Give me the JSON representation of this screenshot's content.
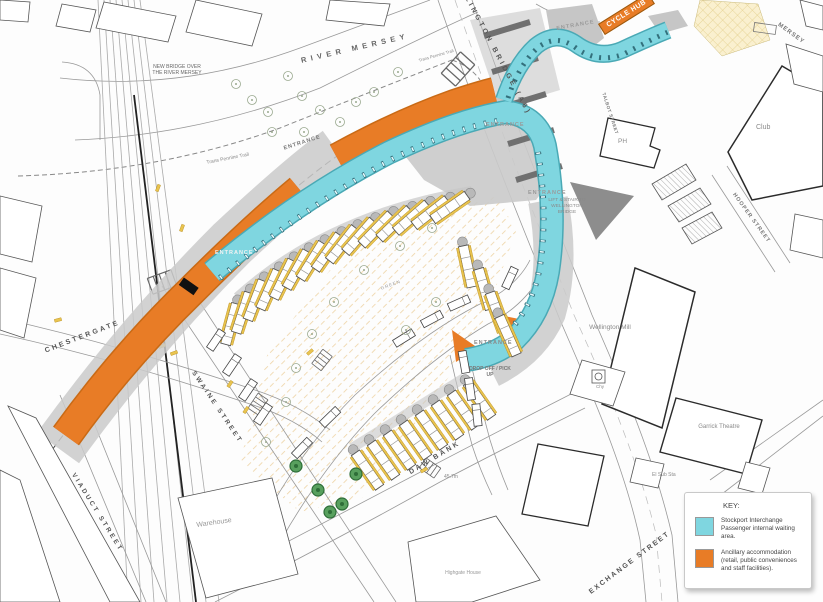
{
  "labels": {
    "river": "RIVER MERSEY",
    "new_bridge": "NEW BRIDGE OVER THE RIVER MERSEY",
    "trail": "Trans Pennine Trail",
    "cycle_hub": "CYCLE HUB",
    "entrance": "ENTRANCE",
    "drop_off": "DROP OFF / PICK UP",
    "lift_stair": "LIFT & STAIR TO WELLINGTON BRIDGE",
    "green": "GREEN",
    "spot_height": "45.7m"
  },
  "streets": {
    "chestergate": "CHESTERGATE",
    "swaine": "SWAINE STREET",
    "viaduct": "VIADUCT STREET",
    "daw_bank": "DAW BANK",
    "exchange": "EXCHANGE STREET",
    "wellington_bridge": "WELLINGTON BRIDGE (A6)",
    "hooper": "HOOPER STREET",
    "talbot": "TALBOT STREET",
    "mersey": "MERSEY"
  },
  "places": {
    "ph": "PH",
    "club": "Club",
    "wellington_mill": "Wellington Mill",
    "chy": "Chy",
    "garrick_theatre": "Garrick Theatre",
    "el_sub_sta": "El Sub Sta",
    "warehouse": "Warehouse",
    "highgate_house": "Highgate House"
  },
  "key": {
    "title": "KEY:",
    "items": [
      {
        "swatch_color": "#7fd6e0",
        "label": "Stockport Interchange Passenger internal waiting area."
      },
      {
        "swatch_color": "#e87c26",
        "label": "Ancillary accommodation (retail, public conveniences and staff facilities)."
      }
    ]
  },
  "colors": {
    "passenger_cyan": "#7fd6e0",
    "ancillary_orange": "#e87c26",
    "apron_grey": "#c9c9c9",
    "hatch_yellow": "#eccf9b"
  }
}
